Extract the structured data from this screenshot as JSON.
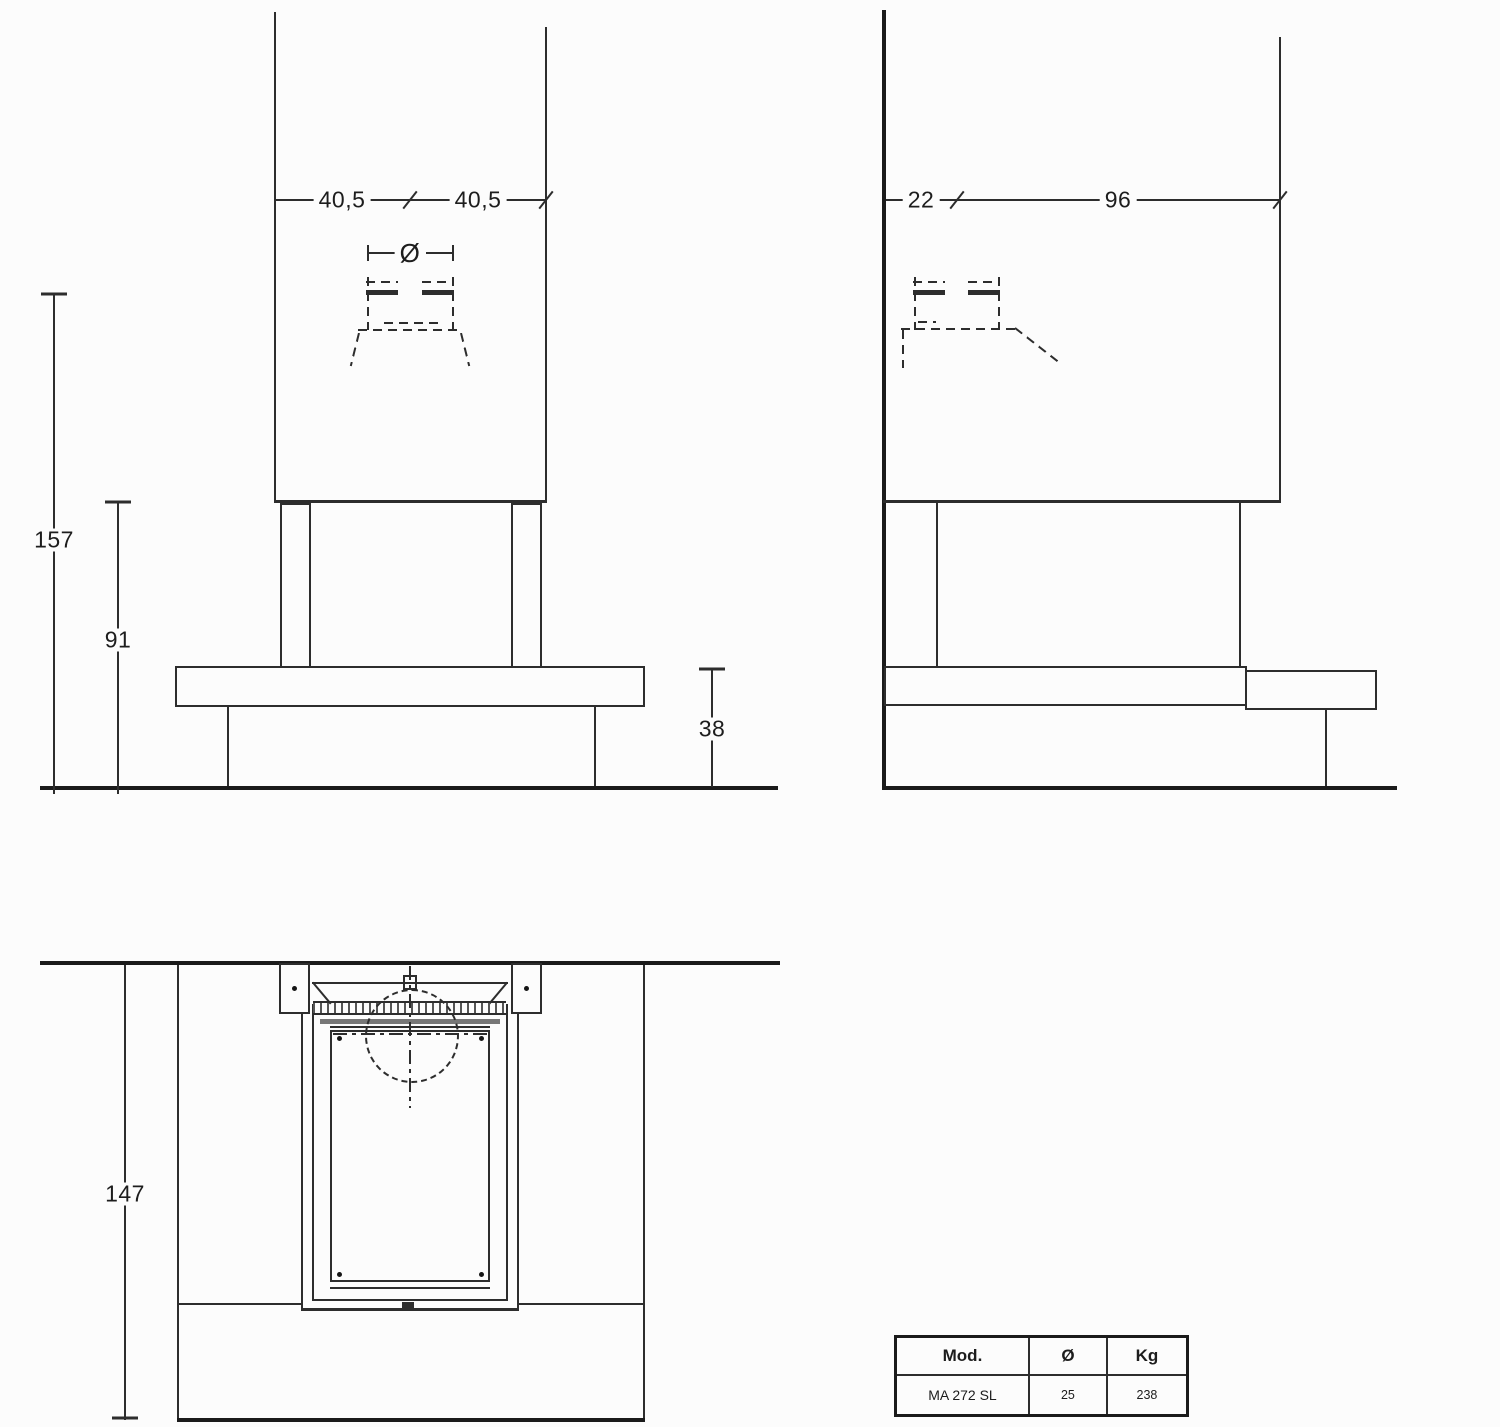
{
  "drawing": {
    "front_view": {
      "dim_top_left": "40,5",
      "dim_top_right": "40,5",
      "flue_diameter_symbol": "Ø",
      "dim_height_total": "157",
      "dim_height_opening": "91",
      "dim_bench_height": "38"
    },
    "side_view": {
      "dim_flue_offset": "22",
      "dim_depth_total": "96"
    },
    "plan_view": {
      "dim_width_total": "147"
    },
    "spec_table": {
      "headers": [
        "Mod.",
        "Ø",
        "Kg"
      ],
      "rows": [
        [
          "MA 272 SL",
          "25",
          "238"
        ]
      ]
    },
    "colors": {
      "line": "#2d2d2d",
      "line_heavy": "#1b1b1b",
      "background": "#fcfcfc"
    }
  }
}
